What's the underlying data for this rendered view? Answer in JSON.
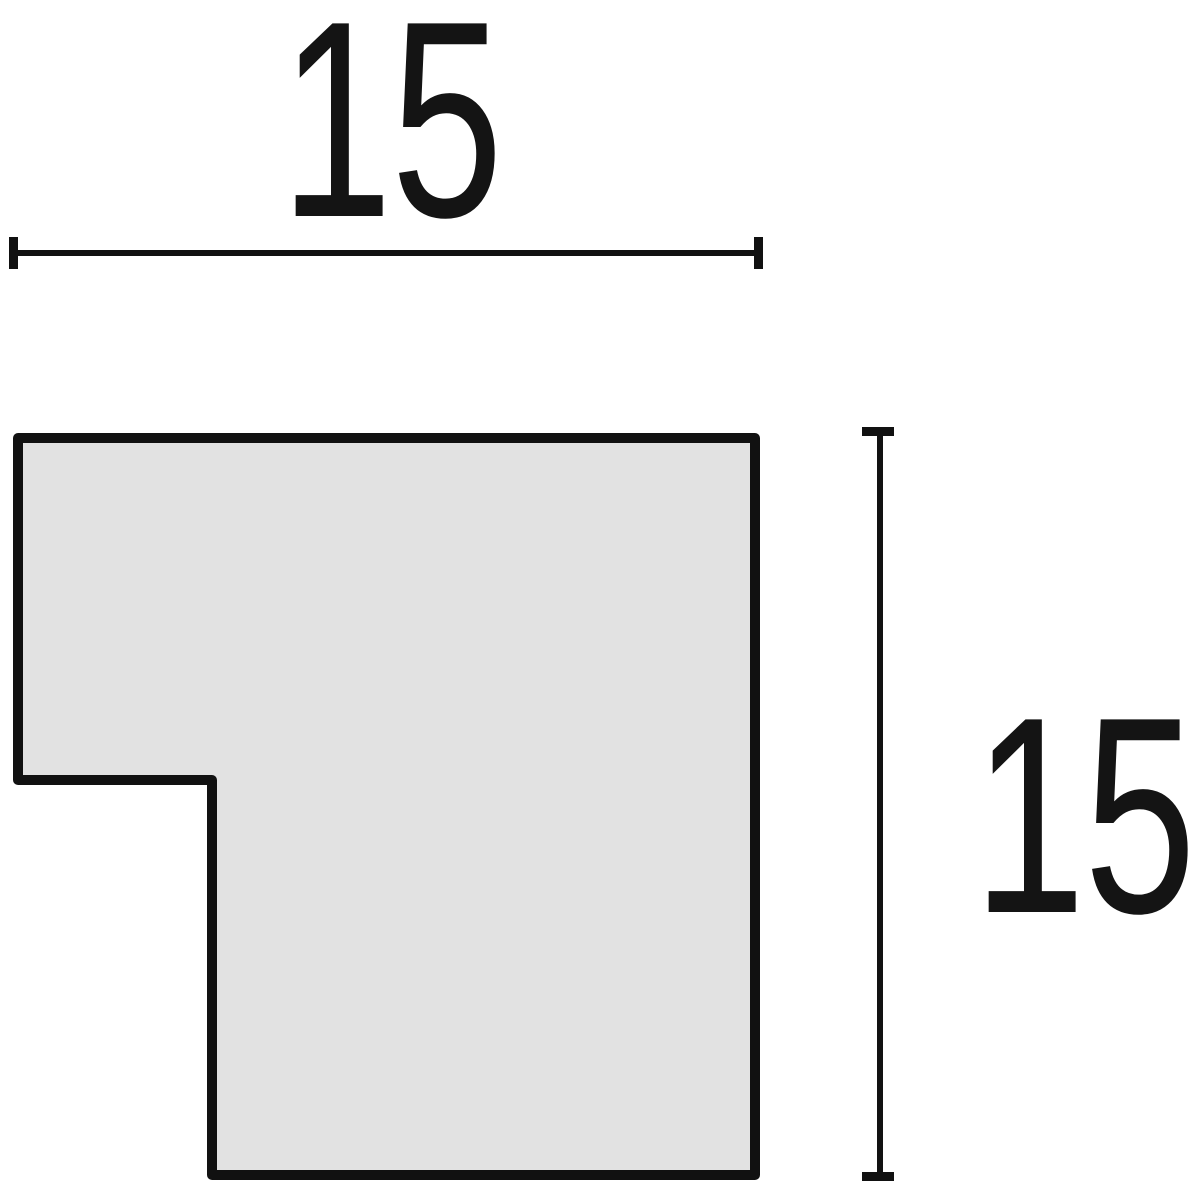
{
  "diagram": {
    "description": "Technical dimension drawing of an L-shaped frame moulding profile cross-section"
  },
  "dimensions": {
    "width": {
      "value": "15"
    },
    "height": {
      "value": "15"
    }
  },
  "profile": {
    "points": "18,438 755,438 755,1175 212,1175 212,780 18,780"
  },
  "colors": {
    "line": "#111111",
    "profile_fill": "#e2e2e2",
    "background": "#ffffff",
    "text": "#141414"
  }
}
